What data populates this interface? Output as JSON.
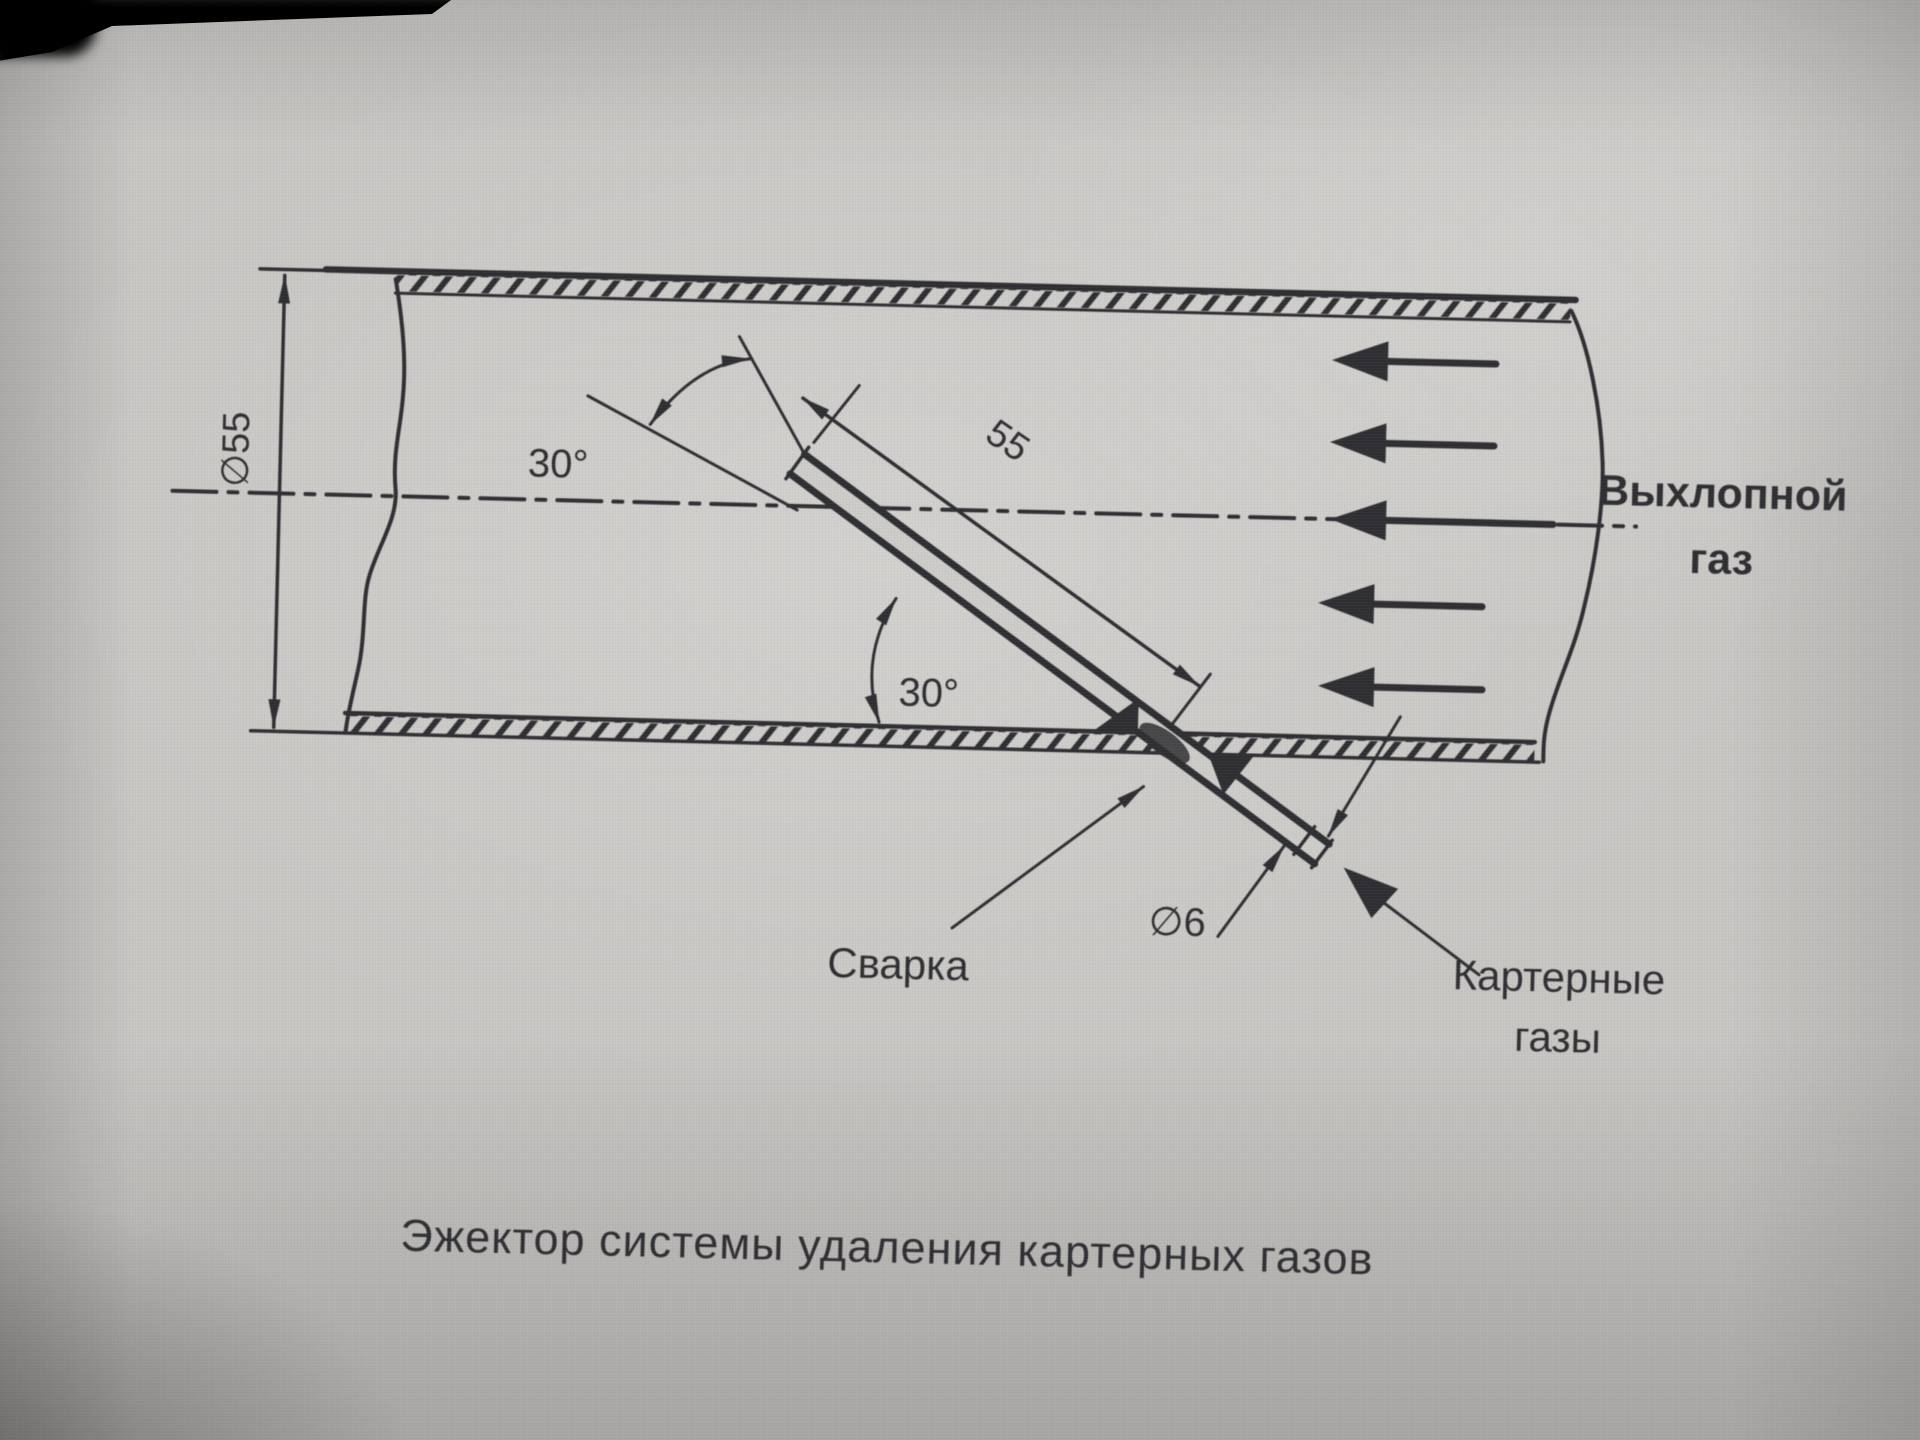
{
  "diagram": {
    "caption": "Эжектор системы удаления картерных газов",
    "labels": {
      "pipe_diameter": "∅55",
      "tube_length": "55",
      "tube_diameter": "∅6",
      "angle_upper": "30°",
      "angle_lower": "30°",
      "exhaust_gas_line1": "Выхлопной",
      "exhaust_gas_line2": "газ",
      "weld": "Сварка",
      "crankcase_line1": "Картерные",
      "crankcase_line2": "газы"
    },
    "colors": {
      "ink": "#302f33",
      "paper": "#c9c7c4"
    }
  }
}
